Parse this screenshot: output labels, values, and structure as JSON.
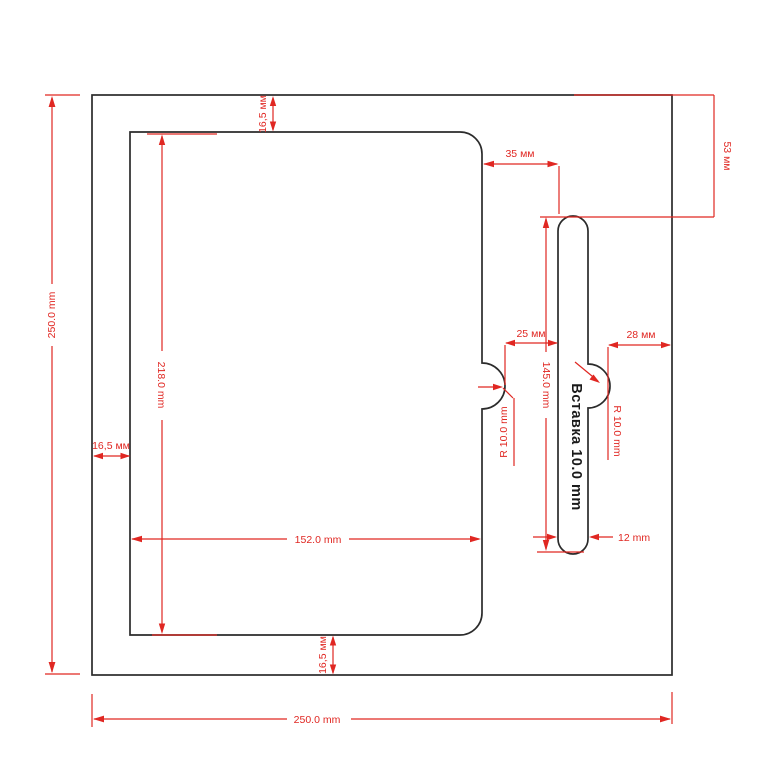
{
  "drawing": {
    "title": "Вставка 10.0 mm",
    "colors": {
      "dimension_red": "#e02722",
      "outline_black": "#2b2b2b",
      "background": "#ffffff"
    },
    "dims": {
      "outer_height": "250.0 mm",
      "outer_width": "250.0 mm",
      "margin_top": "16,5 мм",
      "margin_left": "16,5 мм",
      "margin_bottom": "16,5 мм",
      "cover_height": "218.0 mm",
      "cover_width": "152.0 mm",
      "offset_cover_to_slot_top": "35 мм",
      "gap_cover_to_slot": "25 мм",
      "gap_slot_to_edge": "28 мм",
      "slot_top_offset": "53 мм",
      "slot_height": "145.0 mm",
      "slot_width": "12 mm",
      "notch_radius_left": "R 10.0 mm",
      "notch_radius_right": "R 10.0 mm",
      "insert_label": "Вставка 10.0 mm"
    }
  }
}
